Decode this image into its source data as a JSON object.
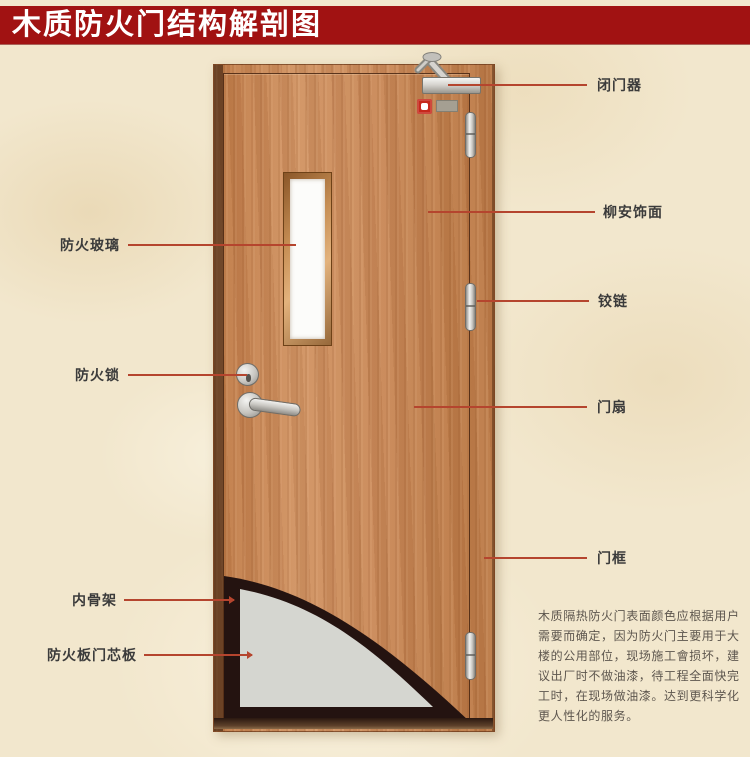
{
  "banner": {
    "title": "木质防火门结构解剖图",
    "bg_color": "#a11212",
    "text_color": "#ffffff"
  },
  "labels": {
    "right": [
      "闭门器",
      "柳安饰面",
      "铰链",
      "门扇",
      "门框"
    ],
    "left": [
      "防火玻璃",
      "防火锁",
      "内骨架",
      "防火板门芯板"
    ]
  },
  "description_lines": [
    "木质隔热防火门表面颜色应根据用户",
    "需要而确定，因为防火门主要用于大",
    "楼的公用部位，现场施工會损坏，建",
    "议出厂时不做油漆，待工程全面快完",
    "工时，在现场做油漆。达到更科学化",
    "更人性化的服务。"
  ],
  "colors": {
    "banner_red": "#a11212",
    "background_parchment": "#f2e7cd",
    "door_wood": "#c8895a",
    "leader_line": "#b5452e",
    "cutaway_dark": "#241310",
    "core_panel_gray": "#d5d6d0"
  }
}
